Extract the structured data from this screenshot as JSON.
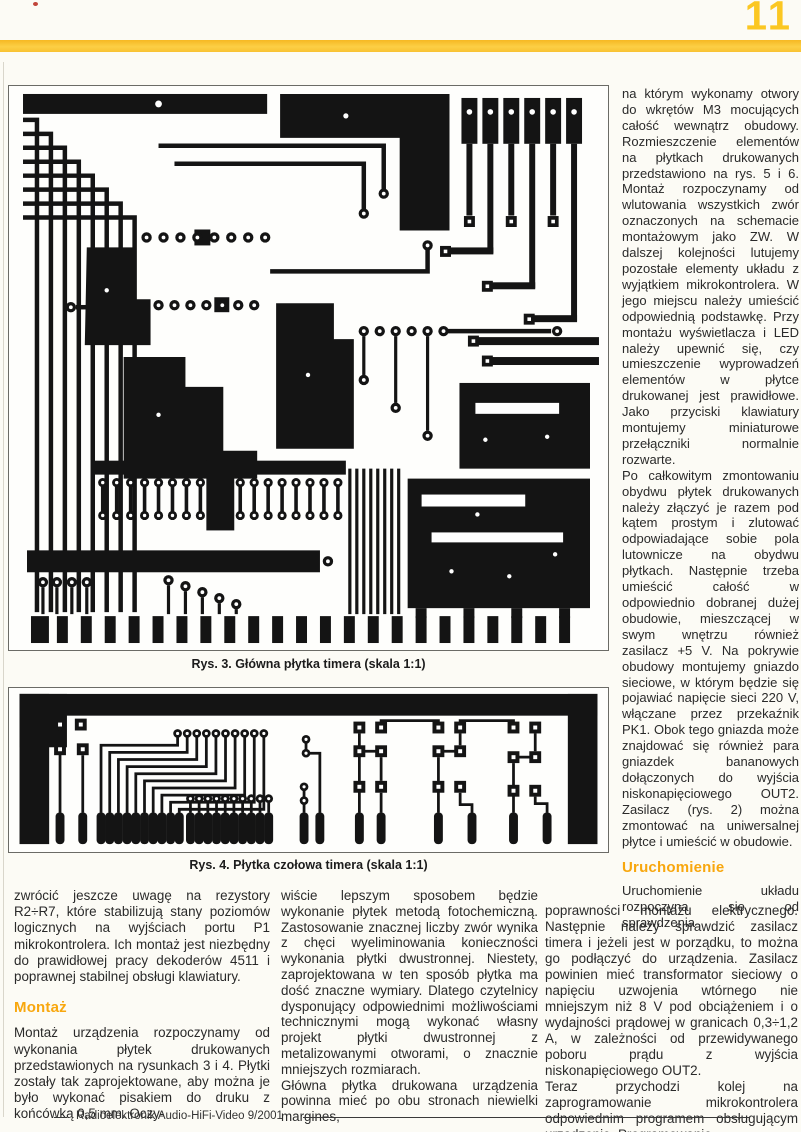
{
  "page": {
    "number": "11",
    "accent_yellow": "#f9c428",
    "heading_orange": "#f8a70e",
    "footer_text": "Radioelektronik Audio-HiFi-Video 9/2001"
  },
  "figures": [
    {
      "id": "rys3",
      "caption": "Rys. 3. Główna płytka timera (skala 1:1)"
    },
    {
      "id": "rys4",
      "caption": "Rys. 4. Płytka czołowa timera (skala 1:1)"
    }
  ],
  "right_column": {
    "para1": "na którym wykonamy otwory do wkrętów M3 mocujących całość wewnątrz obudowy. Rozmieszczenie elementów na płytkach drukowanych przedstawiono na rys. 5 i 6. Montaż rozpoczynamy od wlutowania wszystkich zwór oznaczonych na schemacie montażowym jako ZW. W dalszej kolejności lutujemy pozostałe elementy układu z wyjątkiem mikrokontrolera. W jego miejscu należy umieścić odpowiednią podstawkę. Przy montażu wyświetlacza i LED należy upewnić się, czy umieszczenie wyprowadzeń elementów w płytce drukowanej jest prawidłowe. Jako przyciski klawiatury montujemy miniaturowe przełączniki normalnie rozwarte.",
    "para2": "Po całkowitym zmontowaniu obydwu płytek drukowanych należy złączyć je razem pod kątem prostym i zlutować odpowiadające sobie pola lutownicze na obydwu płytkach. Następnie trzeba umieścić całość w odpowiednio dobranej dużej obudowie, mieszczącej w swym wnętrzu również zasilacz +5 V. Na pokrywie obudowy montujemy gniazdo sieciowe, w którym będzie się pojawiać napięcie sieci 220 V, włączane przez przekaźnik PK1. Obok tego gniazda może znajdować się również para gniazdek bananowych dołączonych do wyjścia niskonapięciowego OUT2. Zasilacz (rys. 2) można zmontować na uniwersalnej płytce i umieścić w obudowie.",
    "heading": "Uruchomienie",
    "para3": "Uruchomienie układu rozpoczyna się od sprawdzenia"
  },
  "bottom": {
    "left": {
      "para1": "zwrócić jeszcze uwagę na rezystory R2÷R7, które stabilizują stany poziomów logicznych na wyjściach portu P1 mikrokontrolera. Ich montaż jest niezbędny do prawidłowej pracy dekoderów 4511 i poprawnej stabilnej obsługi klawiatury.",
      "heading": "Montaż",
      "para2": "Montaż urządzenia rozpoczynamy od wykonania płytek drukowanych przedstawionych na rysunkach 3 i 4. Płytki zostały tak zaprojektowane, aby można je było wykonać pisakiem do druku z końcówką 0,5 mm. Oczy-"
    },
    "middle": {
      "para1": "wiście lepszym sposobem będzie wykonanie płytek metodą fotochemiczną. Zastosowanie znacznej liczby zwór wynika z chęci wyeliminowania konieczności wykonania płytki dwustronnej. Niestety, zaprojektowana w ten sposób płytka ma dość znaczne wymiary. Dlatego czytelnicy dysponujący odpowiednimi możliwościami technicznymi mogą wykonać własny projekt płytki dwustronnej z metalizowanymi otworami, o znacznie mniejszych rozmiarach.",
      "para2": "Główna płytka drukowana urządzenia powinna mieć po obu stronach niewielki margines,"
    },
    "right": {
      "para1": "poprawności montażu elektrycznego. Następnie należy sprawdzić zasilacz timera i jeżeli jest w porządku, to można go podłączyć do urządzenia. Zasilacz powinien mieć transformator sieciowy o napięciu uzwojenia wtórnego nie mniejszym niż 8 V pod obciążeniem i o wydajności prądowej w granicach 0,3÷1,2 A, w zależności od przewidywanego poboru prądu z wyjścia niskonapięciowego OUT2.",
      "para2": "Teraz przychodzi kolej na zaprogramowanie mikrokontrolera odpowiednim programem obsługującym urządzenie. Programowanie"
    }
  }
}
